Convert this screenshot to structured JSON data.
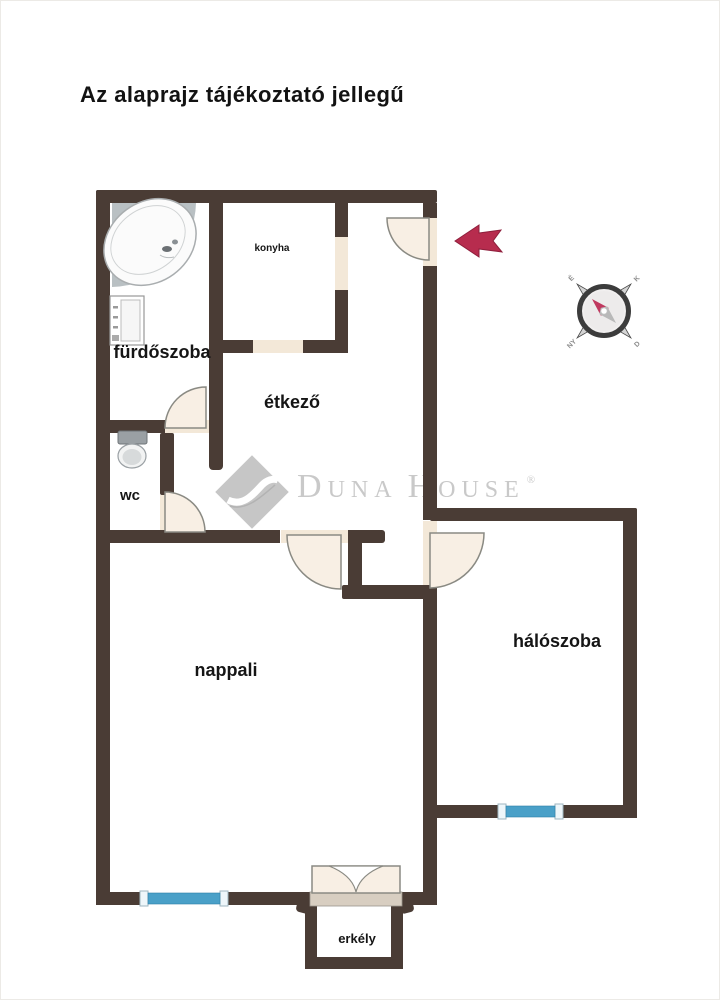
{
  "title": "Az alaprajz tájékoztató jellegű",
  "rooms": {
    "bathroom": "fürdőszoba",
    "wc": "wc",
    "kitchen": "konyha",
    "dining": "étkező",
    "living": "nappali",
    "bedroom": "hálószoba",
    "balcony": "erkély"
  },
  "watermark": {
    "part1": "D",
    "part2": "UNA",
    "part3": "H",
    "part4": "OUSE",
    "registered": "®"
  },
  "compass": {
    "nw": "É",
    "ne": "K",
    "se": "D",
    "sw": "NY"
  },
  "colors": {
    "wall": "#4a3c35",
    "door_fill": "#f8efe4",
    "opening_fill": "#f3e8d8",
    "threshold": "#d8cec1",
    "window_blue": "#4aa0c8",
    "window_cap": "#eef6fa",
    "arrow_red": "#b72c4e",
    "arrow_outline": "#8e1f3c",
    "needle_red": "#c0395f",
    "needle_gray": "#b9b9b9",
    "watermark_gray": "#c9c9c9"
  }
}
